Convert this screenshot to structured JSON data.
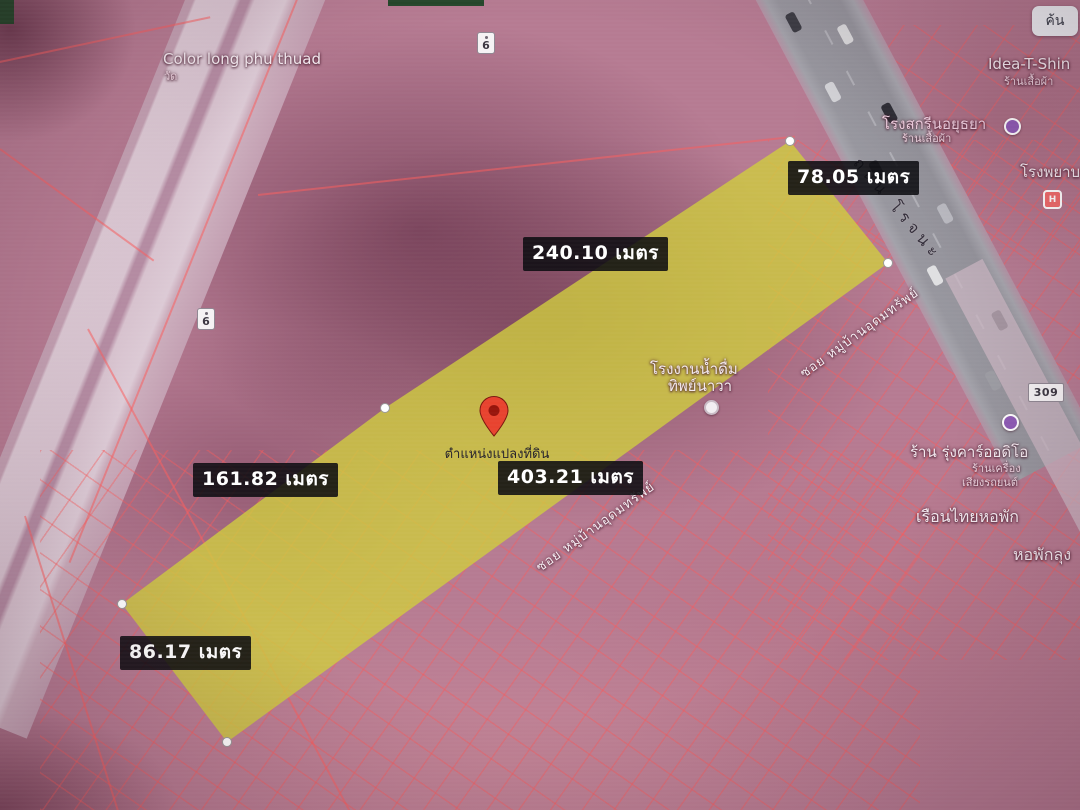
{
  "colors": {
    "plot_fill": "#d0cd3e",
    "parcel_line": "#fa5f5f",
    "pin": "#e8432f",
    "measurement_bg": "#0c0c10",
    "road_gray": "#97969e"
  },
  "map": {
    "search_button_label": "ค้น",
    "marker": {
      "label": "ตำแหน่งแปลงที่ดิน"
    },
    "measurements": [
      {
        "side": "top-right-edge",
        "value": "78.05 เมตร"
      },
      {
        "side": "upper-long-edge",
        "value": "240.10 เมตร"
      },
      {
        "side": "left-long-edge",
        "value": "161.82 เมตร"
      },
      {
        "side": "lower-long-edge",
        "value": "403.21 เมตร"
      },
      {
        "side": "bottom-edge",
        "value": "86.17 เมตร"
      }
    ],
    "roads": [
      {
        "name": "ถนน โรจนะ"
      },
      {
        "name": "ซอย หมู่บ้านอุดมทรัพย์"
      },
      {
        "name": "ซอย หมู่บ้านอุดมทรัพย์"
      }
    ],
    "route_shields": [
      "6",
      "6",
      "309"
    ],
    "places": [
      {
        "name": "Color long phu thuad",
        "sub": "วัด"
      },
      {
        "name": "Idea-T-Shin",
        "sub": "ร้านเสื้อผ้า"
      },
      {
        "name": "โรงสกรีนอยุธยา",
        "sub": "ร้านเสื้อผ้า"
      },
      {
        "name": "โรงพยาบาล"
      },
      {
        "name": "โรงงานน้ำดื่ม",
        "name2": "ทิพย์นาวา"
      },
      {
        "name": "ร้าน รุ่งคาร์ออดิโอ",
        "sub": "ร้านเครื่อง",
        "sub2": "เสียงรถยนต์"
      },
      {
        "name": "เรือนไทยหอพัก"
      },
      {
        "name": "หอพักลุง"
      }
    ],
    "icons": {
      "hospital_glyph": "H"
    }
  }
}
